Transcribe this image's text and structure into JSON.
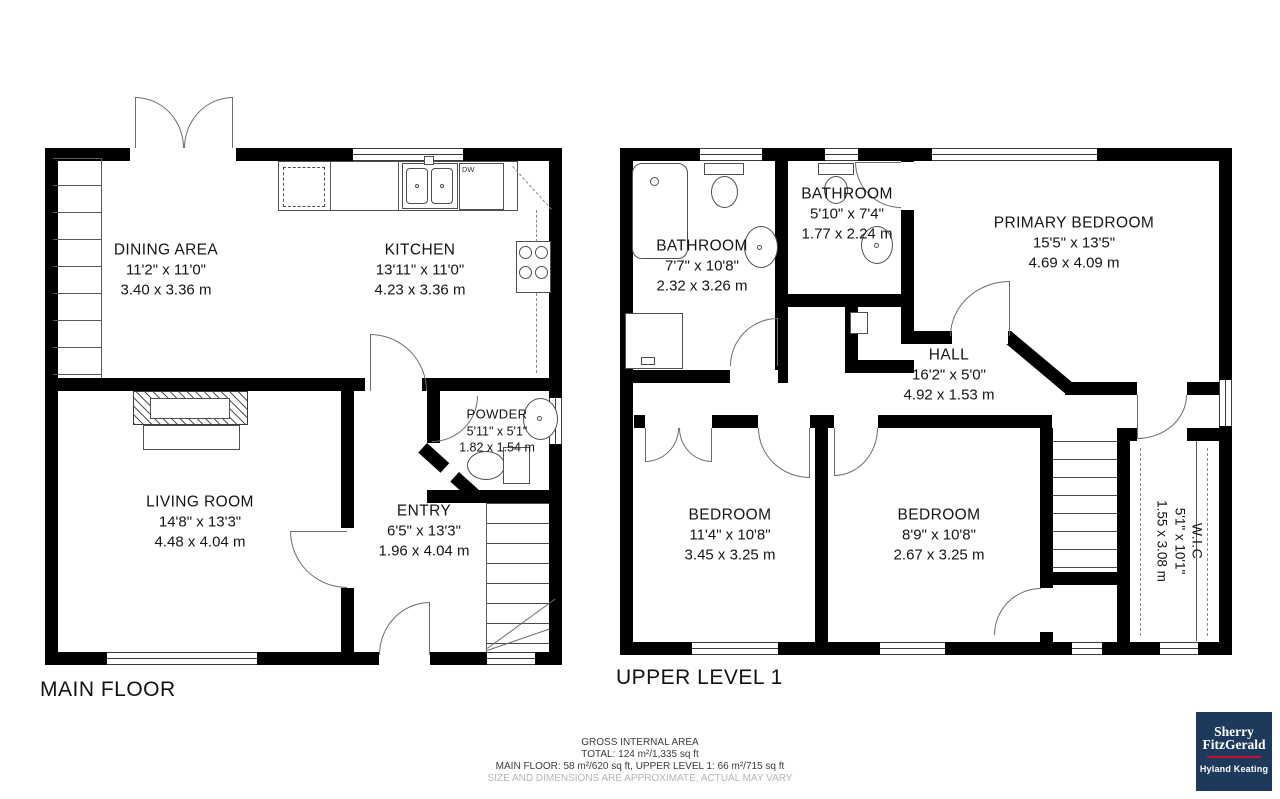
{
  "page": {
    "background_color": "#ffffff"
  },
  "plans": {
    "main_floor": {
      "title": "MAIN FLOOR",
      "rooms": [
        {
          "name": "DINING AREA",
          "imperial": "11'2\" x 11'0\"",
          "metric": "3.40 x 3.36 m"
        },
        {
          "name": "KITCHEN",
          "imperial": "13'11\" x 11'0\"",
          "metric": "4.23 x 3.36 m"
        },
        {
          "name": "LIVING ROOM",
          "imperial": "14'8\" x 13'3\"",
          "metric": "4.48 x 4.04 m"
        },
        {
          "name": "ENTRY",
          "imperial": "6'5\" x 13'3\"",
          "metric": "1.96 x 4.04 m"
        },
        {
          "name": "POWDER",
          "imperial": "5'11\" x 5'1\"",
          "metric": "1.82 x 1.54 m"
        }
      ],
      "labels": {
        "dishwasher": "DW"
      }
    },
    "upper_level": {
      "title": "UPPER LEVEL 1",
      "rooms": [
        {
          "name": "BATHROOM",
          "imperial": "7'7\" x 10'8\"",
          "metric": "2.32 x 3.26 m"
        },
        {
          "name": "BATHROOM",
          "imperial": "5'10\" x 7'4\"",
          "metric": "1.77 x 2.24 m"
        },
        {
          "name": "PRIMARY BEDROOM",
          "imperial": "15'5\" x 13'5\"",
          "metric": "4.69 x 4.09 m"
        },
        {
          "name": "HALL",
          "imperial": "16'2\" x 5'0\"",
          "metric": "4.92 x 1.53 m"
        },
        {
          "name": "BEDROOM",
          "imperial": "11'4\" x 10'8\"",
          "metric": "3.45 x 3.25 m"
        },
        {
          "name": "BEDROOM",
          "imperial": "8'9\" x 10'8\"",
          "metric": "2.67 x 3.25 m"
        },
        {
          "name": "W.I.C",
          "imperial": "5'1\" x 10'1\"",
          "metric": "1.55 x 3.08 m"
        }
      ]
    }
  },
  "footer": {
    "heading": "GROSS INTERNAL AREA",
    "total": "TOTAL: 124 m²/1,335 sq ft",
    "breakdown": "MAIN FLOOR: 58 m²/620 sq ft, UPPER LEVEL 1: 66 m²/715 sq ft",
    "disclaimer": "SIZE AND DIMENSIONS ARE APPROXIMATE, ACTUAL MAY VARY"
  },
  "logo": {
    "brand_line1": "Sherry",
    "brand_line2": "FitzGerald",
    "sub_brand": "Hyland Keating",
    "colors": {
      "navy": "#1d3a5c",
      "red": "#c8102e",
      "text": "#ffffff"
    }
  }
}
